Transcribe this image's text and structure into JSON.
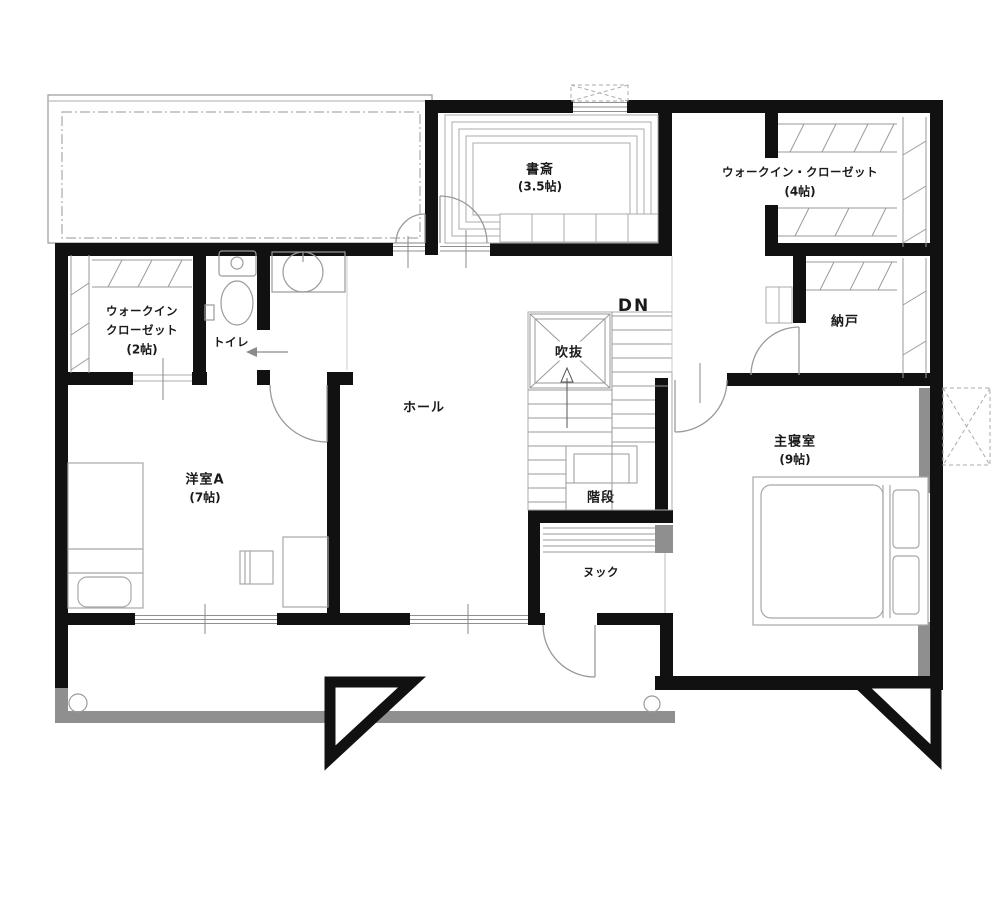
{
  "plan_type": "floor-plan",
  "floor": "2F",
  "labels": {
    "study": {
      "name": "書斎",
      "size": "(3.5帖)"
    },
    "wic4": {
      "line1": "ウォークイン・クローゼット",
      "line2": "(4帖)"
    },
    "wic2": {
      "line1": "ウォークイン",
      "line2": "クローゼット",
      "line3": "(2帖)"
    },
    "toilet": {
      "name": "トイレ"
    },
    "hall": {
      "name": "ホール"
    },
    "void": {
      "name": "吹抜"
    },
    "dn": {
      "name": "DN"
    },
    "storage": {
      "name": "納戸"
    },
    "master": {
      "name": "主寝室",
      "size": "(9帖)"
    },
    "room_a": {
      "name": "洋室A",
      "size": "(7帖)"
    },
    "stairs": {
      "name": "階段"
    },
    "nook": {
      "name": "ヌック"
    }
  },
  "colors": {
    "wall": "#111111",
    "thin_line": "#9a9a9a",
    "furniture": "#a8a8a8",
    "shadow_gray": "#8f8f8f",
    "background": "#ffffff",
    "text": "#1a1a1a"
  }
}
